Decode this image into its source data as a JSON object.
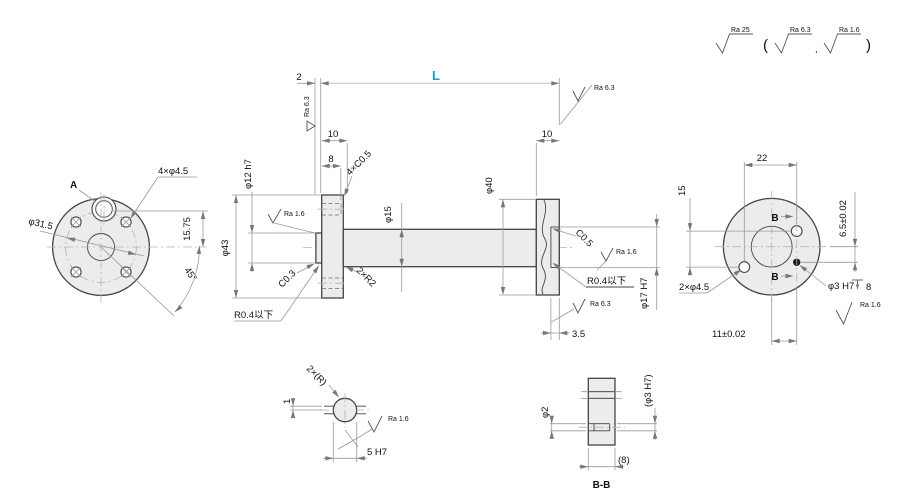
{
  "colors": {
    "accent": "#00A3E0"
  },
  "surface_note": {
    "general": "Ra 25",
    "paren_open": "(",
    "alt1": "Ra 6.3",
    "comma": ",",
    "alt2": "Ra 1.6",
    "paren_close": ")"
  },
  "left_view": {
    "datum": "A",
    "holes": "4×φ4.5",
    "bolt_circle": "φ31.5",
    "offset": "15.75",
    "angle": "45°",
    "flange_dia": "φ43"
  },
  "main_view": {
    "boss_len": "2",
    "length": "L",
    "ra_63": "Ra 6.3",
    "dim_10_left": "10",
    "dim_8": "8",
    "chamfers": "4×C0.5",
    "boss_dia": "φ12 h7",
    "ra_16": "Ra 1.6",
    "chamfer_03": "C0.3",
    "fillet_max": "R0.4以下",
    "fillets": "2×R2",
    "shaft_dia": "φ15",
    "flange2_dia": "φ40",
    "dim_10_right": "10",
    "bore_chamfer": "C0.5",
    "bore_dia": "φ17 H7",
    "bore_depth": "3.5"
  },
  "right_view": {
    "dim_22": "22",
    "section_b": "B",
    "offset_65": "6.5±0.02",
    "dim_15": "15",
    "holes": "2×φ4.5",
    "pin_hole": "φ3 H7",
    "pin_depth": "8",
    "ra_16": "Ra 1.6",
    "offset_11": "11±0.02"
  },
  "detail": {
    "radii": "2×(R)",
    "dim_1": "1",
    "ra_16": "Ra 1.6",
    "slot": "5 H7"
  },
  "section": {
    "hole_dia": "φ2",
    "ref_dia": "(φ3 H7)",
    "ref_8": "(8)",
    "title": "B-B"
  }
}
